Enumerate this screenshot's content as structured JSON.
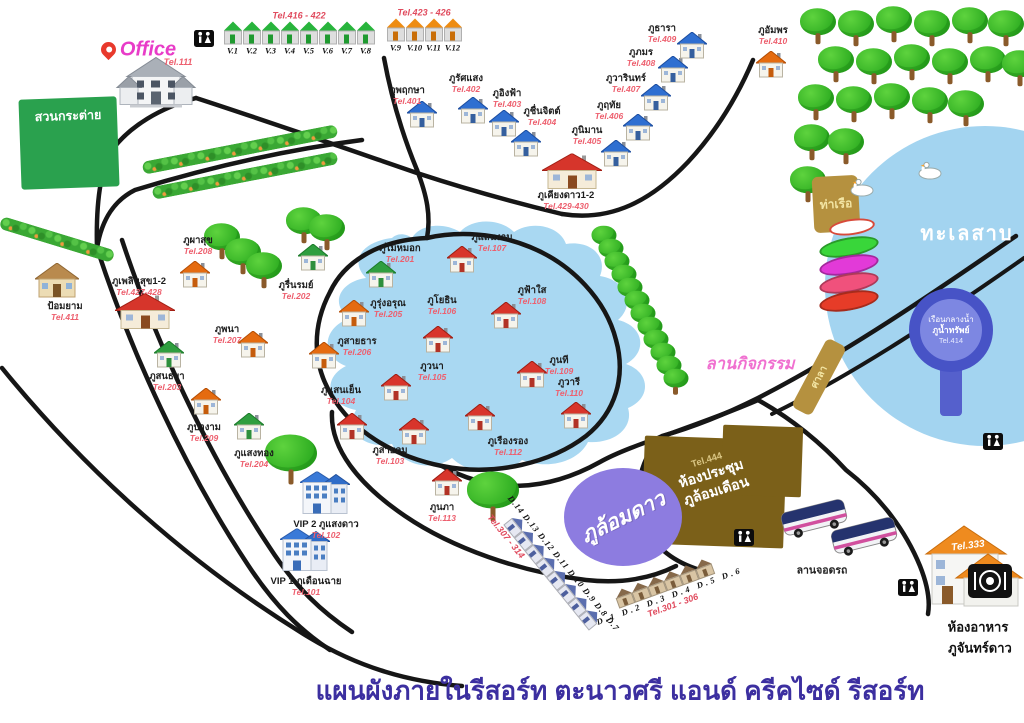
{
  "title": {
    "text": "แผนผังภายในรีสอร์ท ตะนาวศรี แอนด์ ครีคไซด์ รีสอร์ท"
  },
  "office": {
    "label": "Office",
    "tel": "Tel.111"
  },
  "signs": {
    "rabbit_garden": "สวนกระต่าย",
    "lake": "ทะเลสาบ",
    "pier": "ท่าเรือ",
    "pavilion": "ศาลา",
    "activity": "ลานกิจกรรม",
    "parking": "ลานจอดรถ"
  },
  "star_circle": {
    "label": "ภูล้อมดาว"
  },
  "meeting_hall": {
    "tel": "Tel.444",
    "line1": "ห้องประชุม",
    "line2": "ภูล้อมเดือน"
  },
  "restaurant": {
    "tel": "Tel.333",
    "line1": "ห้องอาหาร",
    "line2": "ภูจันทร์ดาว"
  },
  "floating": {
    "line1": "เรือนกลางน้ำ",
    "line2": "ภูน้ำทรัพย์",
    "tel": "Tel.414"
  },
  "villa_rows": [
    {
      "tel_range": "Tel.416 - 422",
      "color": "green",
      "units": [
        "V.1",
        "V.2",
        "V.3",
        "V.4",
        "V.5",
        "V.6",
        "V.7",
        "V.8"
      ]
    },
    {
      "tel_range": "Tel.423 - 426",
      "color": "orange",
      "units": [
        "V.9",
        "V.10",
        "V.11",
        "V.12"
      ]
    }
  ],
  "d_rows": [
    {
      "tel_range": "Tel.307 - 314",
      "units": [
        "D.14",
        "D.13",
        "D.12",
        "D.11",
        "D.10",
        "D.9",
        "D.8",
        "D.7"
      ]
    },
    {
      "tel_range": "Tel.301 - 306",
      "units": [
        "D.1",
        "D.2",
        "D.3",
        "D.4",
        "D.5",
        "D.6"
      ]
    }
  ],
  "houses": [
    {
      "name": "ภูพฤกษา",
      "tel": "Tel.401",
      "type": "blue",
      "hx": 422,
      "hy": 117,
      "lx": 407,
      "ly": 96
    },
    {
      "name": "ภูรัศแสง",
      "tel": "Tel.402",
      "type": "blue",
      "hx": 473,
      "hy": 113,
      "lx": 466,
      "ly": 84
    },
    {
      "name": "ภูอิงฟ้า",
      "tel": "Tel.403",
      "type": "blue",
      "hx": 504,
      "hy": 126,
      "lx": 507,
      "ly": 99
    },
    {
      "name": "ภูชื่นจิตต์",
      "tel": "Tel.404",
      "type": "blue",
      "hx": 526,
      "hy": 146,
      "lx": 542,
      "ly": 117
    },
    {
      "name": "ภูนิมาน",
      "tel": "Tel.405",
      "type": "blue",
      "hx": 616,
      "hy": 156,
      "lx": 587,
      "ly": 136
    },
    {
      "name": "ภูฤทัย",
      "tel": "Tel.406",
      "type": "blue",
      "hx": 638,
      "hy": 130,
      "lx": 609,
      "ly": 111
    },
    {
      "name": "ภูวารินทร์",
      "tel": "Tel.407",
      "type": "blue",
      "hx": 656,
      "hy": 100,
      "lx": 626,
      "ly": 84
    },
    {
      "name": "ภูภมร",
      "tel": "Tel.408",
      "type": "blue",
      "hx": 673,
      "hy": 72,
      "lx": 641,
      "ly": 58
    },
    {
      "name": "ภูธารา",
      "tel": "Tel.409",
      "type": "blue",
      "hx": 692,
      "hy": 48,
      "lx": 662,
      "ly": 34
    },
    {
      "name": "ภูอัมพร",
      "tel": "Tel.410",
      "type": "orange",
      "hx": 771,
      "hy": 67,
      "lx": 773,
      "ly": 36
    },
    {
      "name": "ภูเคียงดาว1-2",
      "tel": "Tel.429-430",
      "type": "bigred",
      "hx": 572,
      "hy": 174,
      "lx": 566,
      "ly": 201
    },
    {
      "name": "ภูเพลินสุข1-2",
      "tel": "Tel.427-428",
      "type": "bigred",
      "hx": 145,
      "hy": 314,
      "lx": 139,
      "ly": 287
    },
    {
      "name": "ป้อมยาม",
      "tel": "Tel.411",
      "type": "cottage",
      "hx": 57,
      "hy": 283,
      "lx": 65,
      "ly": 312
    },
    {
      "name": "ภูผาสุข",
      "tel": "Tel.208",
      "type": "orange",
      "hx": 195,
      "hy": 277,
      "lx": 198,
      "ly": 246
    },
    {
      "name": "ภูรุ่งอรุณ",
      "tel": "Tel.205",
      "type": "orange",
      "hx": 354,
      "hy": 316,
      "lx": 388,
      "ly": 309
    },
    {
      "name": "ภูสายธาร",
      "tel": "Tel.206",
      "type": "orange",
      "hx": 324,
      "hy": 358,
      "lx": 357,
      "ly": 347
    },
    {
      "name": "ภูพนา",
      "tel": "Tel.207",
      "type": "orange",
      "hx": 253,
      "hy": 347,
      "lx": 227,
      "ly": 335
    },
    {
      "name": "ภูป่างาม",
      "tel": "Tel.209",
      "type": "orange",
      "hx": 206,
      "hy": 404,
      "lx": 204,
      "ly": 433
    },
    {
      "name": "ภูไม้หมอก",
      "tel": "Tel.201",
      "type": "green",
      "hx": 381,
      "hy": 277,
      "lx": 400,
      "ly": 254
    },
    {
      "name": "ภูรื่นรมย์",
      "tel": "Tel.202",
      "type": "green",
      "hx": 313,
      "hy": 260,
      "lx": 296,
      "ly": 291
    },
    {
      "name": "ภูสนธยา",
      "tel": "Tel.203",
      "type": "green",
      "hx": 169,
      "hy": 357,
      "lx": 167,
      "ly": 382
    },
    {
      "name": "ภูแสงทอง",
      "tel": "Tel.204",
      "type": "green",
      "hx": 249,
      "hy": 429,
      "lx": 254,
      "ly": 459
    },
    {
      "name": "ภูแสนงาม",
      "tel": "Tel.107",
      "type": "red",
      "hx": 462,
      "hy": 262,
      "lx": 492,
      "ly": 243
    },
    {
      "name": "ภูฟ้าใส",
      "tel": "Tel.108",
      "type": "red",
      "hx": 506,
      "hy": 318,
      "lx": 532,
      "ly": 296
    },
    {
      "name": "ภูโยธิน",
      "tel": "Tel.106",
      "type": "red",
      "hx": 438,
      "hy": 342,
      "lx": 442,
      "ly": 306
    },
    {
      "name": "ภูวนา",
      "tel": "Tel.105",
      "type": "red",
      "hx": 396,
      "hy": 390,
      "lx": 432,
      "ly": 372
    },
    {
      "name": "ภูนที",
      "tel": "Tel.109",
      "type": "red",
      "hx": 532,
      "hy": 377,
      "lx": 559,
      "ly": 366
    },
    {
      "name": "ภูวารี",
      "tel": "Tel.110",
      "type": "red",
      "hx": 576,
      "hy": 418,
      "lx": 569,
      "ly": 388
    },
    {
      "name": "ภูเรืองรอง",
      "tel": "Tel.112",
      "type": "red",
      "hx": 480,
      "hy": 420,
      "lx": 508,
      "ly": 447
    },
    {
      "name": "ภูสายลม",
      "tel": "Tel.103",
      "type": "red",
      "hx": 414,
      "hy": 434,
      "lx": 390,
      "ly": 456
    },
    {
      "name": "ภูแสนเย็น",
      "tel": "Tel.104",
      "type": "red",
      "hx": 352,
      "hy": 429,
      "lx": 341,
      "ly": 396
    },
    {
      "name": "ภูนภา",
      "tel": "Tel.113",
      "type": "red",
      "hx": 447,
      "hy": 485,
      "lx": 442,
      "ly": 513
    },
    {
      "name": "VIP 2 ภูแสงดาว",
      "tel": "Tel.102",
      "type": "vip",
      "hx": 325,
      "hy": 496,
      "lx": 326,
      "ly": 530
    },
    {
      "name": "VIP 1 ภูเดือนฉาย",
      "tel": "Tel.101",
      "type": "vip",
      "hx": 305,
      "hy": 553,
      "lx": 306,
      "ly": 587
    }
  ]
}
